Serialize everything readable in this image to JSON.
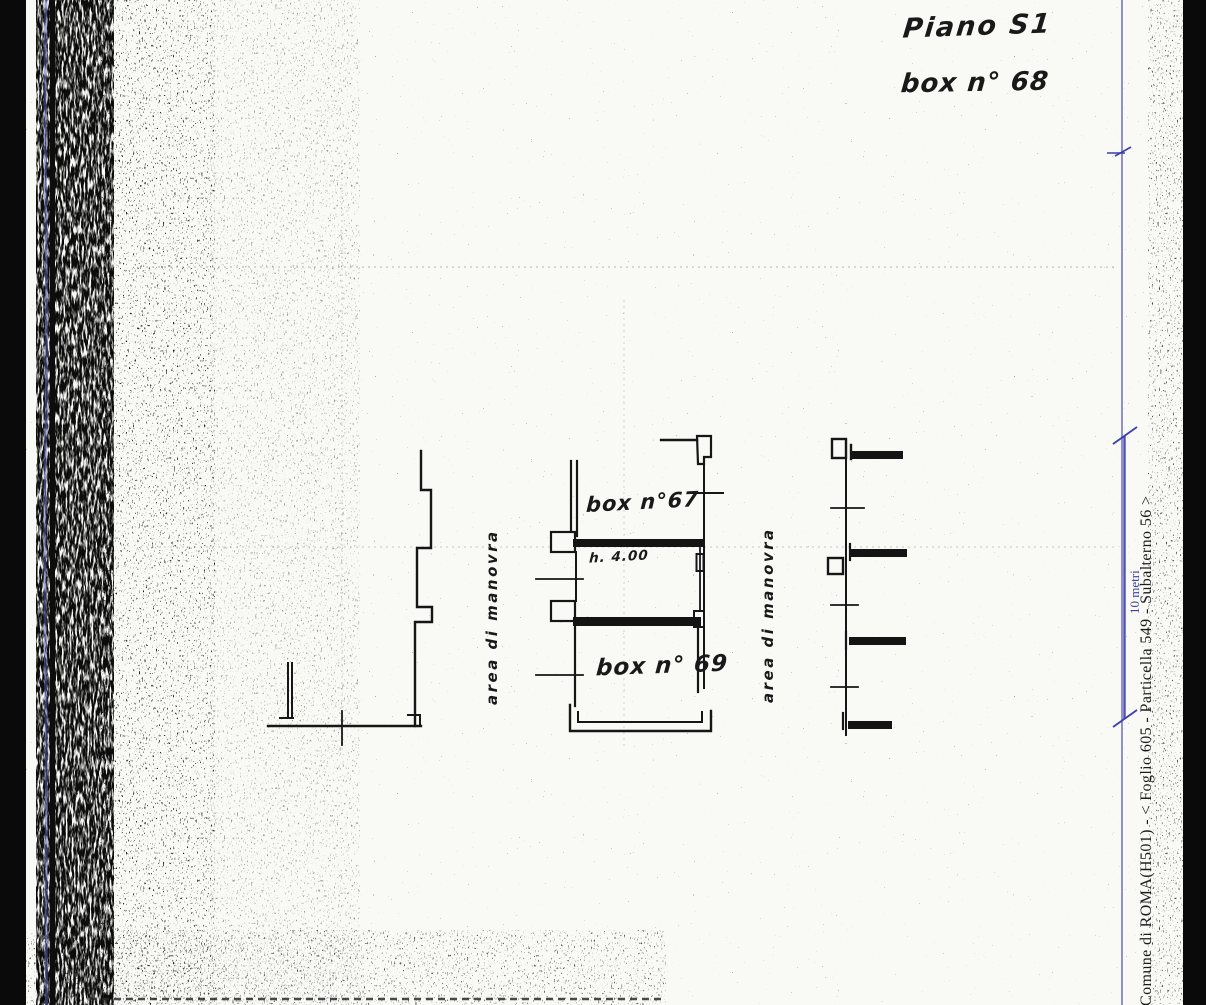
{
  "page": {
    "background_color": "#0a0a0a",
    "paper_color": "#f9f9f6",
    "ink_color": "#1a1a1a",
    "accent_blue": "#3d3dac"
  },
  "header": {
    "floor_label": "Piano S1",
    "unit_label": "box n° 68"
  },
  "plan": {
    "room_67_label": "box n°67",
    "height_label": "h. 4.00",
    "room_69_label": "box n° 69",
    "maneuver_area_label_left": "area di manovra",
    "maneuver_area_label_right": "area di manovra"
  },
  "margin": {
    "cadastral_text": "Comune di ROMA(H501) - < Foglio 605 - Particella 549 - Subalterno 56 >",
    "scale_label": "10 metri"
  }
}
